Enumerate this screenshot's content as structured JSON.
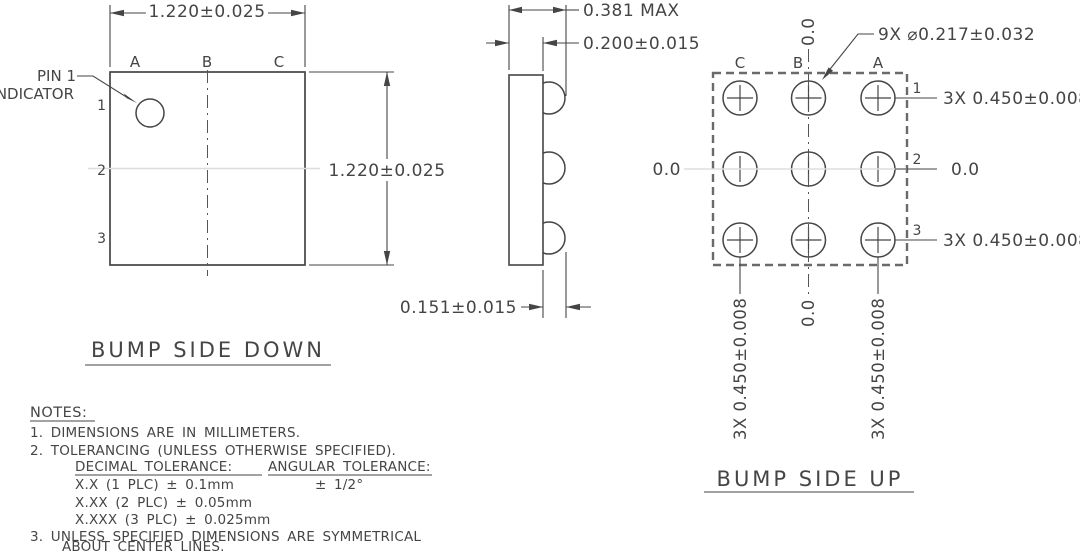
{
  "colors": {
    "line": "#454545",
    "thin": "#4a4a4a",
    "dashed_outline": "#6a6a6a",
    "faint_centerline": "#dddddd",
    "background": "#ffffff"
  },
  "left_view": {
    "title": "BUMP SIDE DOWN",
    "pin1_label_line1": "PIN 1",
    "pin1_label_line2": "INDICATOR",
    "columns": [
      "A",
      "B",
      "C"
    ],
    "rows": [
      "1",
      "2",
      "3"
    ],
    "dim_width": "1.220±0.025",
    "dim_height": "1.220±0.025"
  },
  "side_view": {
    "dim_total_thickness": "0.381 MAX",
    "dim_die_thickness": "0.200±0.015",
    "dim_bump_height": "0.151±0.015"
  },
  "right_view": {
    "title": "BUMP SIDE UP",
    "columns": [
      "C",
      "B",
      "A"
    ],
    "rows": [
      "1",
      "2",
      "3"
    ],
    "bump_diameter_callout": "9X ⌀0.217±0.032",
    "top_datum": "0.0",
    "left_datum": "0.0",
    "right_row_labels": [
      "3X  0.450±0.008",
      "0.0",
      "3X  0.450±0.008"
    ],
    "bottom_col_labels": [
      "3X  0.450±0.008",
      "0.0",
      "3X  0.450±0.008"
    ]
  },
  "notes": {
    "heading": "NOTES:",
    "note1": "1. DIMENSIONS ARE IN MILLIMETERS.",
    "note2": "2. TOLERANCING (UNLESS OTHERWISE SPECIFIED).",
    "decimal_heading": "DECIMAL TOLERANCE:",
    "angular_heading": "ANGULAR TOLERANCE:",
    "decimal_rows": [
      "X.X (1 PLC) ± 0.1mm",
      "X.XX (2 PLC) ± 0.05mm",
      "X.XXX (3 PLC) ± 0.025mm"
    ],
    "angular_value": "± 1/2°",
    "note3_line1": "3. UNLESS SPECIFIED DIMENSIONS ARE SYMMETRICAL",
    "note3_line2": "ABOUT CENTER LINES."
  }
}
